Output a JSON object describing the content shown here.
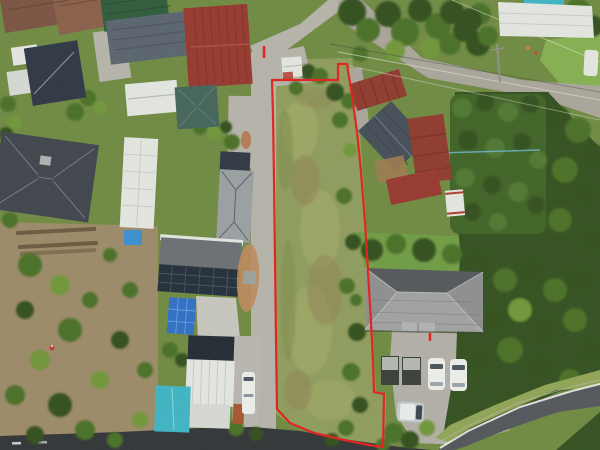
{
  "image": {
    "type": "aerial-drone-photo",
    "subject": "residential neighborhood with a long narrow vacant grass lot outlined by a red property-boundary annotation",
    "width_px": 600,
    "height_px": 450,
    "text_visible": "none"
  },
  "overlay": {
    "boundary_color": "#e2211c",
    "boundary_points": "272,80 338,80 338,64 347,64 352,96 357,132 361,172 365,222 368,272 371,322 373,362 374,392 384,394 383,447 369,445 344,440 314,433 290,423 277,409 276,340 275,260 274,180 273,115",
    "marker_ticks": [
      {
        "name": "road-entrance-tick",
        "x": 264,
        "y1": 46,
        "y2": 58
      },
      {
        "name": "lawn-survey-tick",
        "x": 430,
        "y1": 333,
        "y2": 341
      }
    ]
  },
  "colors": {
    "bg": "#6f8a42",
    "grassLot": "#8f9c5d",
    "grassLight": "#a6ad68",
    "grassDark": "#7e8c4b",
    "patchBrown": "#8f8254",
    "lawn": "#6f9c44",
    "grassField": "#85b050",
    "grassBank": "#90a455",
    "soil": "#9c8a68",
    "rowDark": "#6b5a3e",
    "treeDark": "#33501f",
    "treeMid": "#4a7028",
    "treeLight": "#6f9638",
    "hedge": "#3f6326",
    "hedgeLight": "#4f7731",
    "roadLight": "#b5b3aa",
    "gravel": "#a9a59b",
    "asphalt": "#53565a",
    "asphaltDark": "#313537",
    "parking": "#b2afa7",
    "concrete": "#c6c6be",
    "white": "#e3e5e0",
    "whiteBright": "#eceeea",
    "whiteDim": "#d6d9d3",
    "boundaryRed": "#e2211c",
    "roofRedBig": "#96382e",
    "roofRedBarn": "#8f3a2e",
    "roofGreen": "#2f5c3b",
    "roofTealHip": "#44655a",
    "roofTealCyan": "#3fb4c4",
    "roofNavy": "#2e3744",
    "roofDarkTile": "#454e58",
    "roofBlueGray": "#5a646e",
    "roofGrayLight": "#9aa0a2",
    "roofGrayDark": "#3f454c",
    "shingle": "#6a6f73",
    "houseGrayTop": "#54585a",
    "houseGrayBottom": "#a0a2a1",
    "houseGrayHip": "#8d8f8e",
    "gableGray": "#b0b2b1",
    "roofBrownA": "#7b5342",
    "roofBrownB": "#8a5f49",
    "solar": "#232e3a",
    "tarp": "#2f6fc4",
    "pool": "#3a8fd0",
    "carSilver": "#c2cbcd",
    "wood": "#9c7a4f",
    "shedRed": "#b03a2a",
    "dirtTan": "#bd8a5c",
    "dirtRed": "#b5754c",
    "navyFlat": "#232a33",
    "stripGray": "#b8b6ae",
    "yellow": "#d8c23a",
    "personRed": "#c23b2f"
  },
  "scene": {
    "outlined_lot": {
      "cover": "mowed grass with brown patches",
      "shape": "long narrow strip running north-south",
      "access": "concrete driveway strip along west side"
    },
    "buildings": [
      {
        "id": "brown-metal-roofs-top-left",
        "roof": "roofBrownA"
      },
      {
        "id": "navy-gable-house-top-left",
        "roof": "roofNavy"
      },
      {
        "id": "green-metal-roof-house",
        "roof": "roofGreen"
      },
      {
        "id": "blue-gray-tile-roof",
        "roof": "roofBlueGray"
      },
      {
        "id": "large-red-metal-roof",
        "roof": "roofRedBig"
      },
      {
        "id": "white-long-building",
        "roof": "white"
      },
      {
        "id": "teal-hip-roof-house",
        "roof": "roofTealHip"
      },
      {
        "id": "dark-gray-hip-house-left",
        "roof": "roofGrayDark"
      },
      {
        "id": "white-vertical-building",
        "roof": "white"
      },
      {
        "id": "gray-hip-roof-mid-left",
        "roof": "roofGrayLight"
      },
      {
        "id": "solar-panel-house",
        "roof": "solar"
      },
      {
        "id": "white-corrugated-house-cluster",
        "roof": "white"
      },
      {
        "id": "teal-cyan-roof-building",
        "roof": "roofTealCyan"
      },
      {
        "id": "white-shed-at-lot-entrance",
        "roof": "white"
      },
      {
        "id": "red-barn-roofs-right",
        "roof": "roofRedBarn"
      },
      {
        "id": "dark-tile-gable-house-right",
        "roof": "roofDarkTile"
      },
      {
        "id": "white-red-garden-shed",
        "roof": "shedRed"
      },
      {
        "id": "large-gray-hip-house-bottom-right",
        "roof": "houseGrayBottom"
      },
      {
        "id": "white-warehouse-top-right",
        "roof": "white"
      }
    ],
    "vehicles": [
      {
        "id": "white-suv-1",
        "location": "gravel parking bottom-right"
      },
      {
        "id": "white-suv-2",
        "location": "gravel parking bottom-right"
      },
      {
        "id": "silver-van",
        "location": "gravel parking bottom-right"
      },
      {
        "id": "white-kei-van",
        "location": "courtyard left of lot"
      },
      {
        "id": "white-vehicle",
        "location": "road top-right edge"
      }
    ],
    "landscape": [
      "orchard with fruit trees on brown soil (west)",
      "vegetable garden rows (west)",
      "dense hedge and forest (east)",
      "blue tarp and kiddie pool",
      "gravel parking lot",
      "asphalt road curving bottom-right",
      "power lines crossing top-right"
    ]
  }
}
